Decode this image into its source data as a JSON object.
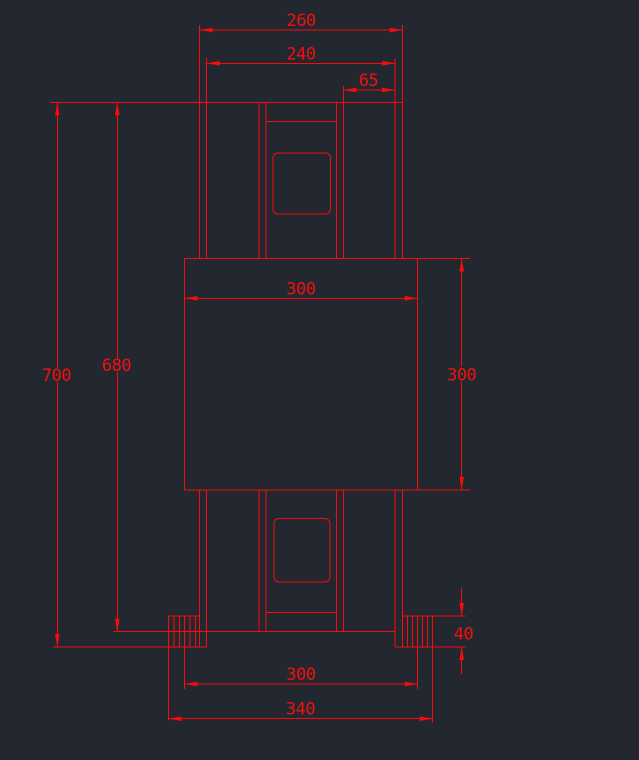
{
  "canvas": {
    "width": 639,
    "height": 760,
    "background_color": "#232830",
    "line_color": "#fa0a0a",
    "text_color": "#f31010"
  },
  "drawing": {
    "description": "Front-view CAD drawing of a symmetric column assembly with central square block, ribbed feet and dimension annotations",
    "lines": [
      {
        "x1": 50,
        "y1": 102.3,
        "x2": 403,
        "y2": 102.3
      },
      {
        "x1": 199.7,
        "y1": 25,
        "x2": 199.7,
        "y2": 258.5
      },
      {
        "x1": 206.7,
        "y1": 58,
        "x2": 206.7,
        "y2": 258.5
      },
      {
        "x1": 259,
        "y1": 102.3,
        "x2": 259,
        "y2": 258.5
      },
      {
        "x1": 266,
        "y1": 102.3,
        "x2": 266,
        "y2": 258.5
      },
      {
        "x1": 336.7,
        "y1": 102.3,
        "x2": 336.7,
        "y2": 258.5
      },
      {
        "x1": 343.3,
        "y1": 86,
        "x2": 343.3,
        "y2": 258.5
      },
      {
        "x1": 395,
        "y1": 58,
        "x2": 395,
        "y2": 258.5
      },
      {
        "x1": 402.7,
        "y1": 25,
        "x2": 402.7,
        "y2": 258.5
      },
      {
        "x1": 266,
        "y1": 121.3,
        "x2": 336.7,
        "y2": 121.3
      },
      {
        "x1": 184.3,
        "y1": 258.5,
        "x2": 470,
        "y2": 258.5
      },
      {
        "x1": 184.3,
        "y1": 490,
        "x2": 470,
        "y2": 490
      },
      {
        "x1": 184.3,
        "y1": 258.5,
        "x2": 184.3,
        "y2": 490
      },
      {
        "x1": 417.7,
        "y1": 258.5,
        "x2": 417.7,
        "y2": 490
      },
      {
        "x1": 199.7,
        "y1": 490,
        "x2": 199.7,
        "y2": 647
      },
      {
        "x1": 206.7,
        "y1": 490,
        "x2": 206.7,
        "y2": 647
      },
      {
        "x1": 259,
        "y1": 490,
        "x2": 259,
        "y2": 631.7
      },
      {
        "x1": 266,
        "y1": 490,
        "x2": 266,
        "y2": 631.7
      },
      {
        "x1": 336.7,
        "y1": 490,
        "x2": 336.7,
        "y2": 631.7
      },
      {
        "x1": 343.3,
        "y1": 490,
        "x2": 343.3,
        "y2": 631.7
      },
      {
        "x1": 395,
        "y1": 490,
        "x2": 395,
        "y2": 647
      },
      {
        "x1": 402.7,
        "y1": 490,
        "x2": 402.7,
        "y2": 647
      },
      {
        "x1": 266,
        "y1": 612.3,
        "x2": 336.7,
        "y2": 612.3
      },
      {
        "x1": 113.3,
        "y1": 631.7,
        "x2": 395,
        "y2": 631.7
      },
      {
        "x1": 168.3,
        "y1": 616,
        "x2": 199.7,
        "y2": 616
      },
      {
        "x1": 53,
        "y1": 647,
        "x2": 206.7,
        "y2": 647
      },
      {
        "x1": 168.3,
        "y1": 616,
        "x2": 168.3,
        "y2": 720
      },
      {
        "x1": 174,
        "y1": 616,
        "x2": 174,
        "y2": 647
      },
      {
        "x1": 179.3,
        "y1": 616,
        "x2": 179.3,
        "y2": 647
      },
      {
        "x1": 184.3,
        "y1": 616,
        "x2": 184.3,
        "y2": 689
      },
      {
        "x1": 190,
        "y1": 616,
        "x2": 190,
        "y2": 647
      },
      {
        "x1": 195.3,
        "y1": 616,
        "x2": 195.3,
        "y2": 647
      },
      {
        "x1": 402.7,
        "y1": 616,
        "x2": 465.7,
        "y2": 616
      },
      {
        "x1": 395,
        "y1": 647,
        "x2": 465.7,
        "y2": 647
      },
      {
        "x1": 432.7,
        "y1": 616,
        "x2": 432.7,
        "y2": 722.7
      },
      {
        "x1": 407.7,
        "y1": 616,
        "x2": 407.7,
        "y2": 647
      },
      {
        "x1": 412.7,
        "y1": 616,
        "x2": 412.7,
        "y2": 647
      },
      {
        "x1": 417.7,
        "y1": 616,
        "x2": 417.7,
        "y2": 689
      },
      {
        "x1": 422.7,
        "y1": 616,
        "x2": 422.7,
        "y2": 647
      },
      {
        "x1": 427.7,
        "y1": 616,
        "x2": 427.7,
        "y2": 647
      }
    ],
    "rounded_rects": [
      {
        "x": 273,
        "y": 153,
        "w": 57.5,
        "h": 61,
        "r": 5
      },
      {
        "x": 274,
        "y": 518.5,
        "w": 56,
        "h": 63.5,
        "r": 5
      }
    ],
    "dimensions": [
      {
        "label": "260",
        "segments": [
          {
            "x1": 199.7,
            "y1": 30,
            "x2": 402.7,
            "y2": 30
          }
        ],
        "arrows": [
          {
            "x": 199.7,
            "y": 30,
            "dir": "left"
          },
          {
            "x": 402.7,
            "y": 30,
            "dir": "right"
          }
        ],
        "text": {
          "x": 301.2,
          "y": 26
        }
      },
      {
        "label": "240",
        "segments": [
          {
            "x1": 206.7,
            "y1": 63.3,
            "x2": 395,
            "y2": 63.3
          }
        ],
        "arrows": [
          {
            "x": 206.7,
            "y": 63.3,
            "dir": "left"
          },
          {
            "x": 395,
            "y": 63.3,
            "dir": "right"
          }
        ],
        "text": {
          "x": 301,
          "y": 59.3
        }
      },
      {
        "label": "65",
        "segments": [
          {
            "x1": 343.3,
            "y1": 90,
            "x2": 395,
            "y2": 90
          }
        ],
        "arrows": [
          {
            "x": 343.3,
            "y": 90,
            "dir": "left"
          },
          {
            "x": 395,
            "y": 90,
            "dir": "right"
          }
        ],
        "text": {
          "x": 368.5,
          "y": 86
        }
      },
      {
        "label": "700",
        "segments": [
          {
            "x1": 57.3,
            "y1": 102.3,
            "x2": 57.3,
            "y2": 368
          },
          {
            "x1": 57.3,
            "y1": 382,
            "x2": 57.3,
            "y2": 647
          }
        ],
        "arrows": [
          {
            "x": 57.3,
            "y": 102.3,
            "dir": "up"
          },
          {
            "x": 57.3,
            "y": 647,
            "dir": "down"
          }
        ],
        "text": {
          "x": 56.5,
          "y": 381
        }
      },
      {
        "label": "680",
        "segments": [
          {
            "x1": 117.3,
            "y1": 102.3,
            "x2": 117.3,
            "y2": 358
          },
          {
            "x1": 117.3,
            "y1": 372,
            "x2": 117.3,
            "y2": 631.7
          }
        ],
        "arrows": [
          {
            "x": 117.3,
            "y": 102.3,
            "dir": "up"
          },
          {
            "x": 117.3,
            "y": 631.7,
            "dir": "down"
          }
        ],
        "text": {
          "x": 116.5,
          "y": 371
        }
      },
      {
        "label": "300",
        "segments": [
          {
            "x1": 184.3,
            "y1": 298.3,
            "x2": 417.7,
            "y2": 298.3
          }
        ],
        "arrows": [
          {
            "x": 184.3,
            "y": 298.3,
            "dir": "left"
          },
          {
            "x": 417.7,
            "y": 298.3,
            "dir": "right"
          }
        ],
        "text": {
          "x": 301,
          "y": 294.3
        }
      },
      {
        "label": "300",
        "segments": [
          {
            "x1": 461.7,
            "y1": 258.5,
            "x2": 461.7,
            "y2": 366.5
          },
          {
            "x1": 461.7,
            "y1": 381.5,
            "x2": 461.7,
            "y2": 490
          }
        ],
        "arrows": [
          {
            "x": 461.7,
            "y": 258.5,
            "dir": "up"
          },
          {
            "x": 461.7,
            "y": 490,
            "dir": "down"
          }
        ],
        "text": {
          "x": 461.7,
          "y": 380.5
        }
      },
      {
        "label": "40",
        "segments": [
          {
            "x1": 461.7,
            "y1": 588,
            "x2": 461.7,
            "y2": 616
          },
          {
            "x1": 461.7,
            "y1": 647,
            "x2": 461.7,
            "y2": 674
          }
        ],
        "arrows": [
          {
            "x": 461.7,
            "y": 616,
            "dir": "down"
          },
          {
            "x": 461.7,
            "y": 647,
            "dir": "up"
          }
        ],
        "text": {
          "x": 463.5,
          "y": 639.5
        }
      },
      {
        "label": "300",
        "segments": [
          {
            "x1": 184.3,
            "y1": 684,
            "x2": 417.7,
            "y2": 684
          }
        ],
        "arrows": [
          {
            "x": 184.3,
            "y": 684,
            "dir": "left"
          },
          {
            "x": 417.7,
            "y": 684,
            "dir": "right"
          }
        ],
        "text": {
          "x": 301,
          "y": 680
        }
      },
      {
        "label": "340",
        "segments": [
          {
            "x1": 168.3,
            "y1": 718.7,
            "x2": 432.7,
            "y2": 718.7
          }
        ],
        "arrows": [
          {
            "x": 168.3,
            "y": 718.7,
            "dir": "left"
          },
          {
            "x": 432.7,
            "y": 718.7,
            "dir": "right"
          }
        ],
        "text": {
          "x": 300.5,
          "y": 714.7
        }
      }
    ]
  }
}
